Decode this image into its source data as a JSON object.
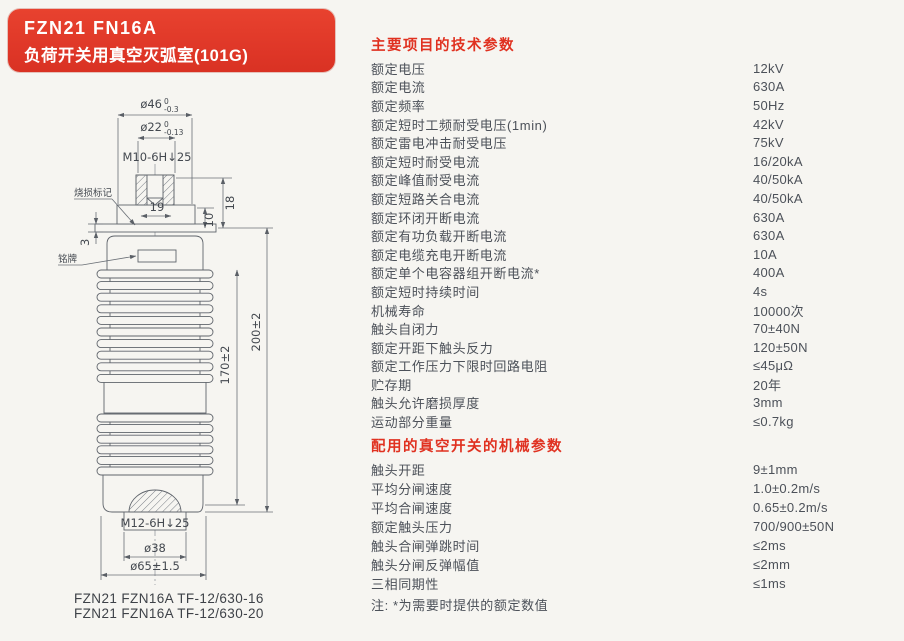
{
  "colors": {
    "accent_red": "#e03120",
    "card_red": "#de3627",
    "text": "#4c5159",
    "line": "#60656c"
  },
  "header": {
    "model": "FZN21 FN16A",
    "subtitle": "负荷开关用真空灭弧室(101G)"
  },
  "drawing": {
    "labels": {
      "burn_mark": "烧损标记",
      "nameplate": "铭牌"
    },
    "dims": {
      "d46": {
        "base": "ø46",
        "sup": "0",
        "sub": "-0.3"
      },
      "d22": {
        "base": "ø22",
        "sup": "0",
        "sub": "-0.13"
      },
      "thread_top": "M10-6H↓25",
      "d19": "19",
      "d18": "18",
      "d10": "10",
      "d3": "3",
      "len_inner": "170±2",
      "len_outer": "200±2",
      "thread_bottom": "M12-6H↓25",
      "d38": "ø38",
      "d65": "ø65±1.5"
    },
    "captions": [
      "FZN21 FZN16A TF-12/630-16",
      "FZN21 FZN16A TF-12/630-20"
    ]
  },
  "specs": {
    "title": "主要项目的技术参数",
    "rows": [
      {
        "label": "额定电压",
        "value": "12kV"
      },
      {
        "label": "额定电流",
        "value": "630A"
      },
      {
        "label": "额定频率",
        "value": "50Hz"
      },
      {
        "label": "额定短时工频耐受电压(1min)",
        "value": "42kV"
      },
      {
        "label": "额定雷电冲击耐受电压",
        "value": "75kV"
      },
      {
        "label": "额定短时耐受电流",
        "value": "16/20kA"
      },
      {
        "label": "额定峰值耐受电流",
        "value": "40/50kA"
      },
      {
        "label": "额定短路关合电流",
        "value": "40/50kA"
      },
      {
        "label": "额定环闭开断电流",
        "value": "630A"
      },
      {
        "label": "额定有功负载开断电流",
        "value": "630A"
      },
      {
        "label": "额定电缆充电开断电流",
        "value": "10A"
      },
      {
        "label": "额定单个电容器组开断电流*",
        "value": "400A"
      },
      {
        "label": "额定短时持续时间",
        "value": "4s"
      },
      {
        "label": "机械寿命",
        "value": "10000次"
      },
      {
        "label": "触头自闭力",
        "value": "70±40N"
      },
      {
        "label": "额定开距下触头反力",
        "value": "120±50N"
      },
      {
        "label": "额定工作压力下限时回路电阻",
        "value": "≤45μΩ"
      },
      {
        "label": "贮存期",
        "value": "20年"
      },
      {
        "label": "触头允许磨损厚度",
        "value": "3mm"
      },
      {
        "label": "运动部分重量",
        "value": "≤0.7kg"
      }
    ]
  },
  "mech": {
    "title": "配用的真空开关的机械参数",
    "rows": [
      {
        "label": "触头开距",
        "value": "9±1mm"
      },
      {
        "label": "平均分闸速度",
        "value": "1.0±0.2m/s"
      },
      {
        "label": "平均合闸速度",
        "value": "0.65±0.2m/s"
      },
      {
        "label": "额定触头压力",
        "value": "700/900±50N"
      },
      {
        "label": "触头合闸弹跳时间",
        "value": "≤2ms"
      },
      {
        "label": "触头分闸反弹幅值",
        "value": "≤2mm"
      },
      {
        "label": "三相同期性",
        "value": "≤1ms"
      }
    ],
    "note": "注: *为需要时提供的额定数值"
  }
}
